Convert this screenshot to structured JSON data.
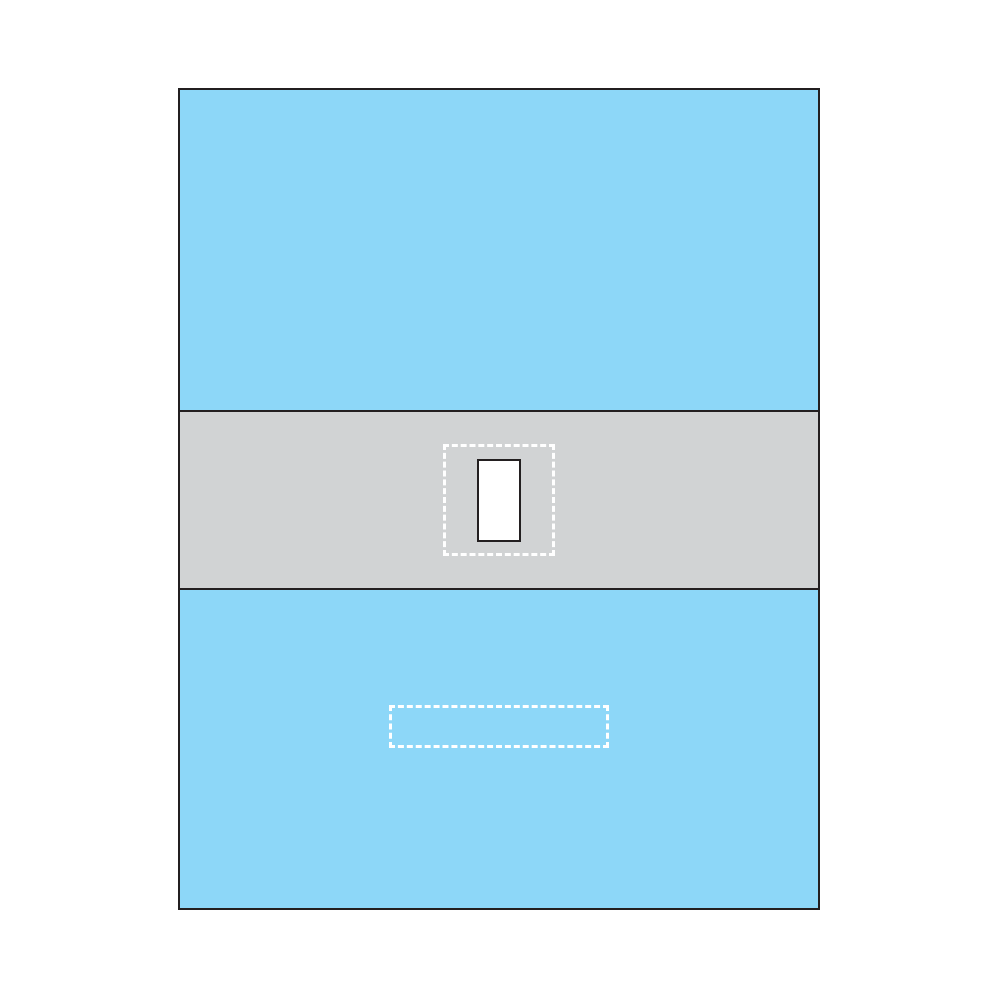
{
  "diagram": {
    "colors": {
      "page_background": "#FFFFFF",
      "drape_blue": "#8DD7F8",
      "band_gray": "#D1D3D4",
      "outline_dark": "#231F20",
      "dash_white": "#FFFFFF",
      "aperture_fill": "#FFFFFF"
    }
  }
}
